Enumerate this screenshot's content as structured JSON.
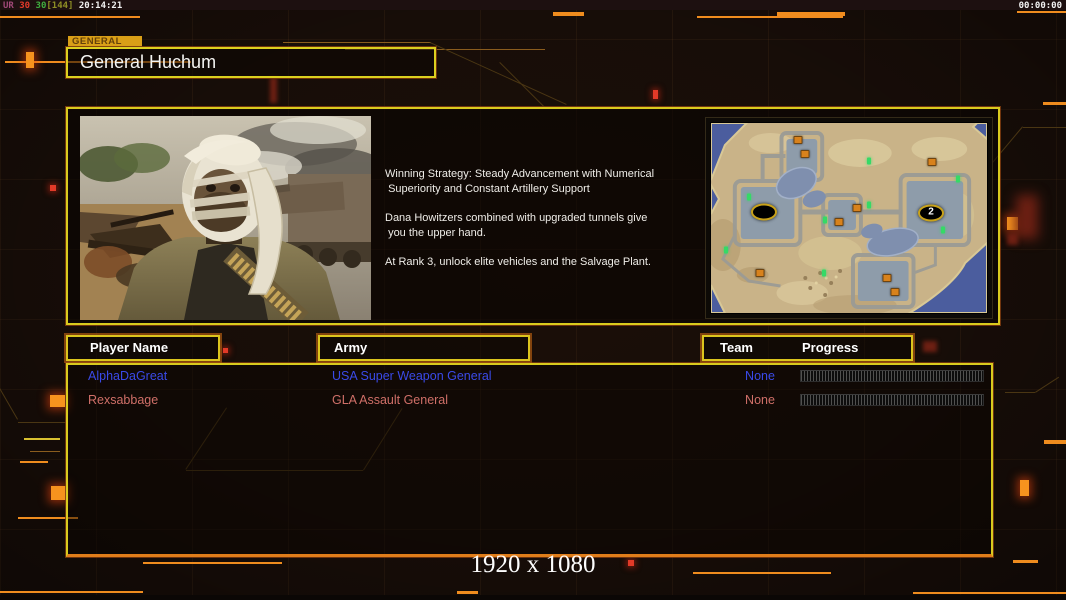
{
  "top_bar": {
    "frame_counter": {
      "ur": "UR",
      "fps_a": "30",
      "fps_b": "30",
      "bracket": "[144]",
      "time": "20:14:21"
    },
    "clock": "00:00:00"
  },
  "header": {
    "tab": "GENERAL",
    "title": "General Huchum"
  },
  "strategy": {
    "lines": [
      [
        "Winning Strategy: Steady Advancement with Numerical",
        " Superiority and Constant Artillery Support"
      ],
      [
        "Dana Howitzers combined with upgraded tunnels give",
        " you the upper hand."
      ],
      [
        "At Rank 3, unlock elite vehicles and the Salvage Plant."
      ]
    ]
  },
  "minimap": {
    "markers": {
      "starts": [
        {
          "x": 19.1,
          "y": 47.0,
          "label": ""
        },
        {
          "x": 79.7,
          "y": 47.5,
          "label": "2"
        }
      ],
      "supplies": [
        {
          "x": 31.7,
          "y": 9.1
        },
        {
          "x": 33.9,
          "y": 16.5
        },
        {
          "x": 80.2,
          "y": 20.6
        },
        {
          "x": 52.8,
          "y": 44.6
        },
        {
          "x": 46.5,
          "y": 52.0
        },
        {
          "x": 17.9,
          "y": 79.2
        },
        {
          "x": 63.7,
          "y": 81.7
        },
        {
          "x": 66.5,
          "y": 89.1
        }
      ],
      "units": [
        {
          "x": 57.4,
          "y": 19.8
        },
        {
          "x": 89.4,
          "y": 29.7
        },
        {
          "x": 13.9,
          "y": 38.8
        },
        {
          "x": 57.4,
          "y": 42.9
        },
        {
          "x": 41.4,
          "y": 51.2
        },
        {
          "x": 84.2,
          "y": 56.1
        },
        {
          "x": 5.4,
          "y": 66.8
        },
        {
          "x": 40.8,
          "y": 79.2
        }
      ]
    }
  },
  "table": {
    "headers": {
      "player": "Player Name",
      "army": "Army",
      "team": "Team",
      "progress": "Progress"
    },
    "rows": [
      {
        "player": "AlphaDaGreat",
        "army": "USA Super Weapon General",
        "team": "None",
        "progress_percent": 3,
        "color": "#3a4ae8"
      },
      {
        "player": "Rexsabbage",
        "army": "GLA Assault General",
        "team": "None",
        "progress_percent": 0,
        "color": "#cf6f68"
      }
    ]
  },
  "footer": {
    "resolution": "1920 x 1080"
  },
  "colors": {
    "accent_yellow": "#d9cb1e",
    "accent_orange": "#e07d1a",
    "progress_fill_blue": "#3f55f2"
  }
}
